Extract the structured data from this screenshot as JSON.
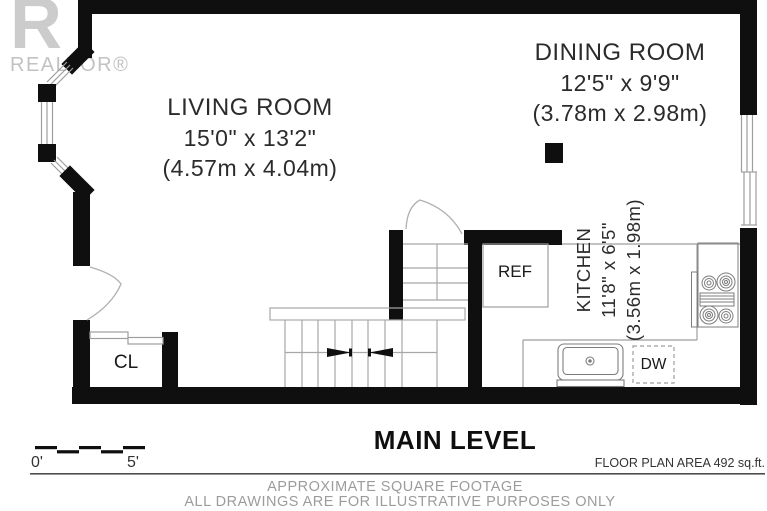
{
  "branding": {
    "logo_letter": "R",
    "logo_text": "REALTOR®"
  },
  "rooms": {
    "living": {
      "name": "LIVING ROOM",
      "imperial": "15'0\" x 13'2\"",
      "metric": "(4.57m x 4.04m)"
    },
    "dining": {
      "name": "DINING ROOM",
      "imperial": "12'5\" x 9'9\"",
      "metric": "(3.78m x 2.98m)"
    },
    "kitchen": {
      "name": "KITCHEN",
      "imperial": "11'8\" x 6'5\"",
      "metric": "(3.56m x 1.98m)"
    }
  },
  "labels": {
    "refrigerator": "REF",
    "dishwasher": "DW",
    "closet": "CL"
  },
  "scale": {
    "start": "0'",
    "end": "5'"
  },
  "footer": {
    "level_title": "MAIN LEVEL",
    "area_note": "FLOOR PLAN AREA 492 sq.ft.",
    "disclaimer_line1": "APPROXIMATE SQUARE FOOTAGE",
    "disclaimer_line2": "ALL DRAWINGS ARE FOR ILLUSTRATIVE PURPOSES ONLY"
  },
  "colors": {
    "wall": "#0f0f0f",
    "thin_line": "#9e9e9e",
    "muted_text": "#9c9c9c",
    "logo_gray": "#c6c6c6"
  }
}
